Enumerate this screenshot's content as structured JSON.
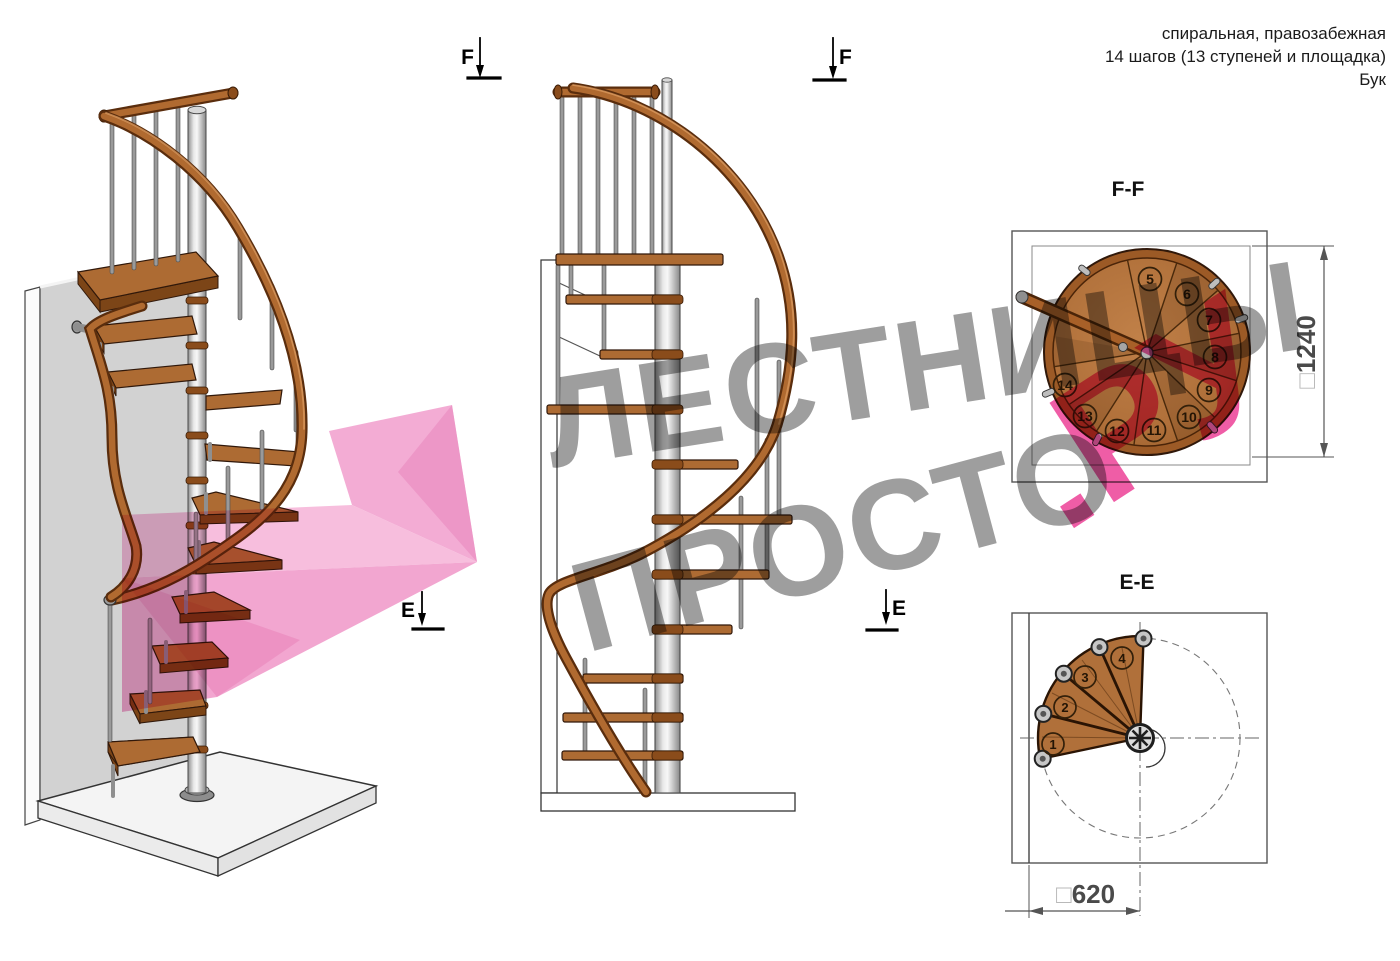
{
  "annotation": {
    "line1": "спиральная, правозабежная",
    "line2": "14 шагов (13 ступеней и площадка)",
    "line3": "Бук"
  },
  "markers": {
    "f": "F",
    "e": "E"
  },
  "views": {
    "iso": {
      "description": "3d-view-of-spiral-staircase"
    },
    "elevation": {
      "description": "side-elevation-of-spiral-staircase"
    },
    "ff": {
      "label": "F-F",
      "dim_symbol": "□",
      "dimension": "1240",
      "steps": [
        {
          "n": "5",
          "x": 1150,
          "y": 279
        },
        {
          "n": "6",
          "x": 1187,
          "y": 294
        },
        {
          "n": "7",
          "x": 1209,
          "y": 320
        },
        {
          "n": "8",
          "x": 1215,
          "y": 357
        },
        {
          "n": "9",
          "x": 1209,
          "y": 390
        },
        {
          "n": "10",
          "x": 1189,
          "y": 417
        },
        {
          "n": "11",
          "x": 1154,
          "y": 430
        },
        {
          "n": "12",
          "x": 1117,
          "y": 431
        },
        {
          "n": "13",
          "x": 1085,
          "y": 416
        },
        {
          "n": "14",
          "x": 1065,
          "y": 385
        }
      ]
    },
    "ee": {
      "label": "E-E",
      "dim_symbol": "□",
      "dimension": "620",
      "steps": [
        {
          "n": "1",
          "x": 1053,
          "y": 744
        },
        {
          "n": "2",
          "x": 1065,
          "y": 707
        },
        {
          "n": "3",
          "x": 1085,
          "y": 677
        },
        {
          "n": "4",
          "x": 1122,
          "y": 658
        }
      ]
    }
  },
  "watermark": {
    "line1": "ЛЕСТНИЦЫ",
    "line2": "ПРОСТО",
    "suffix": ".РУ"
  },
  "colors": {
    "wood": "#b0703a",
    "wood_dark": "#7c4517",
    "rail": "#a86028",
    "pink_accent": "#ee4f9f",
    "pink_arrow": "#f2a3cf",
    "watermark_gray": "#969696",
    "pole_gray": "#c9c9c9",
    "wall_gray": "#d2d2d2"
  }
}
